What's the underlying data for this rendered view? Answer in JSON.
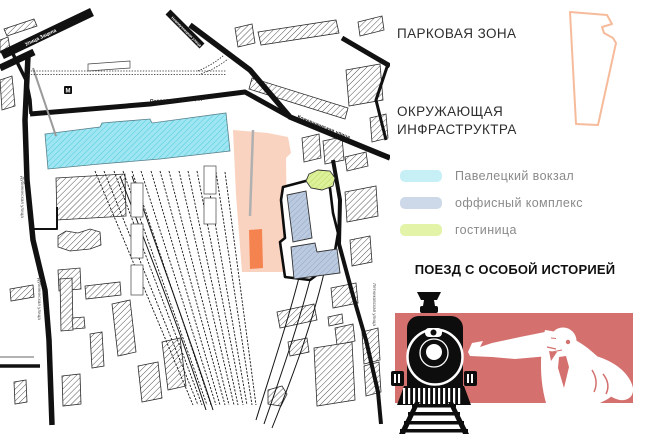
{
  "right_panel": {
    "park_zone_title": "ПАРКОВАЯ ЗОНА",
    "infra_title_line1": "ОКРУЖАЮЩАЯ",
    "infra_title_line2": "ИНФРАСТРУКТРА",
    "legend": [
      {
        "label": "Павелецкий вокзал",
        "color": "#c7eff6"
      },
      {
        "label": "оффисный комплекс",
        "color": "#cdd9e8"
      },
      {
        "label": "гостиница",
        "color": "#e3f3a7"
      }
    ],
    "train_title": "ПОЕЗД С ОСОБОЙ ИСТОРИЕЙ"
  },
  "map": {
    "labels": {
      "street_top_left": "Улица Зацепа",
      "street_top_right": "Новокузнецкая улица",
      "square": "Павелецкая площадь",
      "street_east": "Кожевническая улица",
      "street_west": "Дубининская улица",
      "street_southeast": "Летниковская улица",
      "metro": "M"
    },
    "zones": {
      "station_color": "#9fe6f2",
      "office_color": "#bccadf",
      "hotel_color": "#ddf09a",
      "park_color": "#f9d3c0",
      "accent_orange": "#f5834f"
    }
  },
  "illustration": {
    "banner_color": "#d4716e",
    "outline_color": "#f6bb9b"
  }
}
